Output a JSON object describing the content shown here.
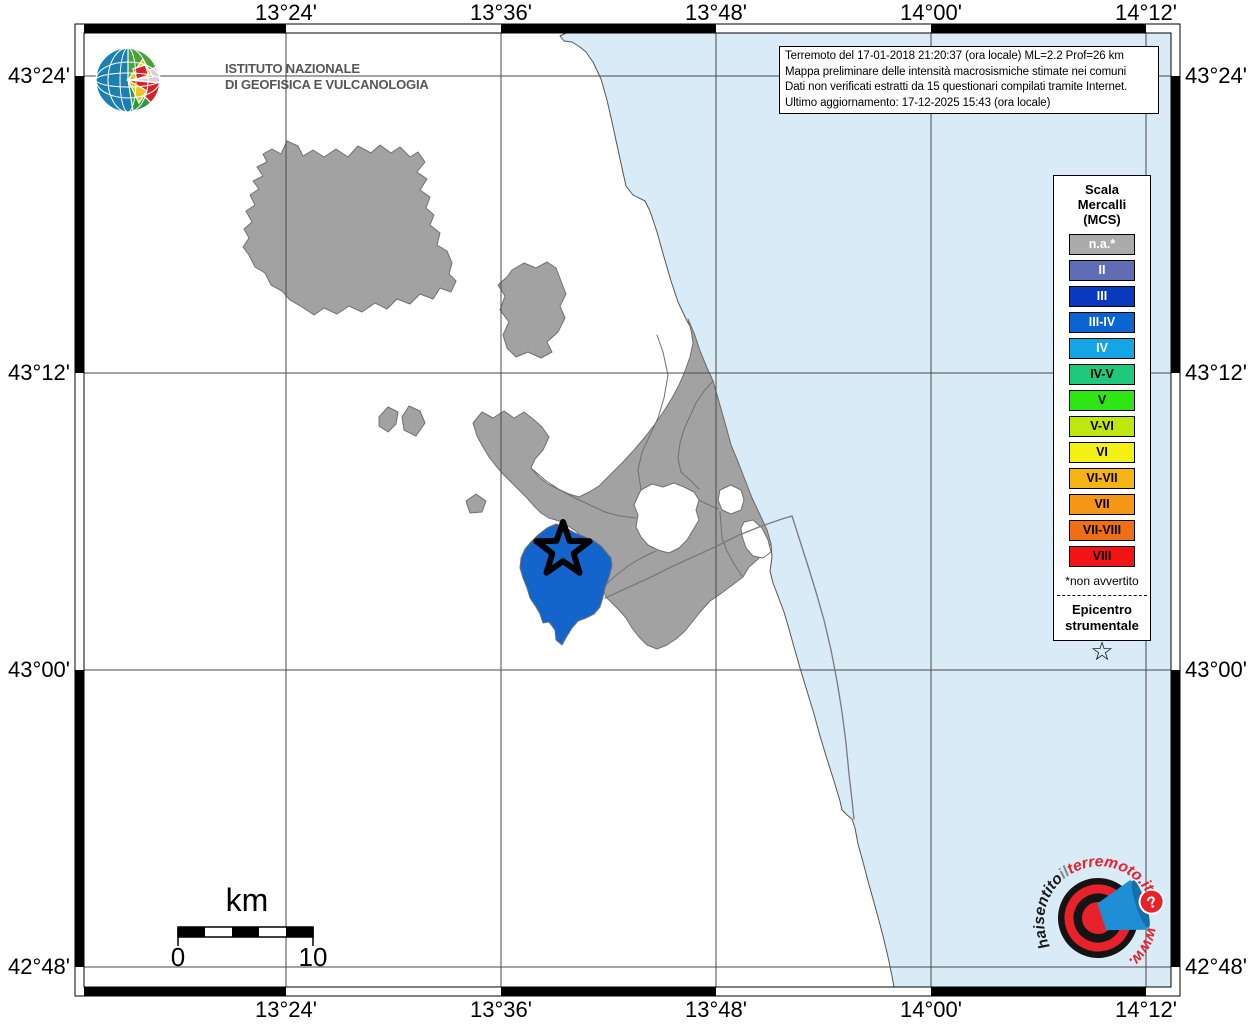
{
  "info_box": {
    "line1": "Terremoto del 17-01-2018 21:20:37 (ora locale) ML=2.2 Prof=26 km",
    "line2": "Mappa preliminare delle intensità macrosismiche stimate nei comuni",
    "line3": "Dati non verificati estratti da 15 questionari compilati tramite Internet.",
    "line4": "Ultimo aggiornamento: 17-12-2025 15:43 (ora locale)"
  },
  "frame": {
    "top_labels": [
      "13°24'",
      "13°36'",
      "13°48'",
      "14°00'",
      "14°12'"
    ],
    "bottom_labels": [
      "13°24'",
      "13°36'",
      "13°48'",
      "14°00'",
      "14°12'"
    ],
    "left_labels": [
      "43°24'",
      "43°12'",
      "43°00'",
      "42°48'"
    ],
    "right_labels": [
      "43°24'",
      "43°12'",
      "43°00'",
      "42°48'"
    ]
  },
  "ingv_logo": {
    "name_line1": "ISTITUTO NAZIONALE",
    "name_line2": "DI GEOFISICA E VULCANOLOGIA"
  },
  "legend": {
    "title_line1": "Scala",
    "title_line2": "Mercalli",
    "title_line3": "(MCS)",
    "items": [
      {
        "label": "n.a.*",
        "color": "#ABABAB",
        "text_color": "#FFFFFF"
      },
      {
        "label": "II",
        "color": "#5F6EB4",
        "text_color": "#FFFFFF"
      },
      {
        "label": "III",
        "color": "#0839BE",
        "text_color": "#FFFFFF"
      },
      {
        "label": "III-IV",
        "color": "#0A64D2",
        "text_color": "#FFFFFF"
      },
      {
        "label": "IV",
        "color": "#14A5E6",
        "text_color": "#FFFFFF"
      },
      {
        "label": "IV-V",
        "color": "#1EC87D",
        "text_color": "#000000"
      },
      {
        "label": "V",
        "color": "#2DE614",
        "text_color": "#000000"
      },
      {
        "label": "V-VI",
        "color": "#BEE60F",
        "text_color": "#000000"
      },
      {
        "label": "VI",
        "color": "#F5F014",
        "text_color": "#000000"
      },
      {
        "label": "VI-VII",
        "color": "#F5B414",
        "text_color": "#000000"
      },
      {
        "label": "VII",
        "color": "#F59614",
        "text_color": "#000000"
      },
      {
        "label": "VII-VIII",
        "color": "#F06E14",
        "text_color": "#000000"
      },
      {
        "label": "VIII",
        "color": "#F01414",
        "text_color": "#000000"
      }
    ],
    "footnote": "*non avvertito",
    "epicenter_line1": "Epicentro",
    "epicenter_line2": "strumentale",
    "epicenter_star": "☆"
  },
  "scale_bar": {
    "unit_label": "km",
    "start_label": "0",
    "end_label": "10"
  },
  "site_logo": {
    "arc_hai": "haisentito",
    "arc_il": "il",
    "arc_site": "terremoto.it",
    "arc_www": "www.",
    "badge": "?"
  },
  "map": {
    "inner": [
      84,
      33,
      1171,
      987
    ],
    "outer": [
      75,
      24,
      1180,
      996
    ],
    "grid_x": [
      286,
      501,
      716,
      931,
      1146
    ],
    "grid_y": [
      76,
      373,
      670,
      967
    ],
    "grid_color": "#4A4A4A",
    "sea_color": "#D9EBF7",
    "land_color": "#FFFFFF",
    "muni_fill": "#A2A2A2",
    "muni_stroke": "#707070",
    "felt_fill": "#1465CB",
    "layers": [
      {
        "name": "sea",
        "fill": "#D9EBF7",
        "stroke": "#555555",
        "sw": 1,
        "d": "M 566 33 L 560 36 L 564 41 L 572 42 L 580 47 L 586 52 L 593 62 L 601 79 L 607 100 L 612 122 L 617 145 L 622 168 L 626 186 L 633 195 L 645 201 L 650 211 L 657 232 L 664 257 L 671 281 L 678 302 L 687 321 L 694 333 L 700 351 L 707 368 L 713 381 L 719 402 L 725 423 L 731 445 L 738 462 L 745 480 L 752 498 L 760 515 L 767 530 L 771 544 L 772 557 L 770 571 L 773 583 L 778 596 L 784 612 L 789 629 L 794 647 L 800 668 L 807 691 L 814 714 L 820 736 L 827 759 L 834 781 L 840 801 L 842 810 L 847 815 L 852 819 L 855 828 L 858 844 L 863 862 L 868 881 L 873 899 L 878 917 L 883 936 L 888 957 L 892 976 L 894 987 L 1171 987 L 1171 33 Z"
      },
      {
        "name": "municipality-northwest",
        "fill": "#A2A2A2",
        "stroke": "#707070",
        "sw": 1,
        "d": "M 281 154 L 287 141 L 298 146 L 303 156 L 313 150 L 324 157 L 336 149 L 348 157 L 358 146 L 371 153 L 380 145 L 391 153 L 400 147 L 410 157 L 418 152 L 425 162 L 417 172 L 427 179 L 420 190 L 430 197 L 426 208 L 434 215 L 430 225 L 440 233 L 437 245 L 447 251 L 452 263 L 449 274 L 456 281 L 451 292 L 440 288 L 433 299 L 420 294 L 410 304 L 397 299 L 387 309 L 375 303 L 362 312 L 349 306 L 337 314 L 324 308 L 314 315 L 302 307 L 290 300 L 282 291 L 271 285 L 265 273 L 255 267 L 249 255 L 243 247 L 249 238 L 244 229 L 252 222 L 246 211 L 255 205 L 250 195 L 259 189 L 253 181 L 263 176 L 257 167 L 267 162 L 263 154 L 272 149 Z"
      },
      {
        "name": "municipality-north-center",
        "fill": "#A2A2A2",
        "stroke": "#707070",
        "sw": 1,
        "d": "M 512 270 L 524 263 L 536 268 L 547 262 L 556 268 L 561 281 L 566 294 L 560 306 L 565 318 L 558 332 L 547 342 L 552 352 L 541 358 L 528 352 L 516 357 L 507 348 L 503 335 L 509 322 L 500 310 L 505 296 L 498 285 L 507 277 Z"
      },
      {
        "name": "municipality-islet-a",
        "fill": "#A2A2A2",
        "stroke": "#707070",
        "sw": 1,
        "d": "M 379 417 L 388 407 L 398 412 L 396 424 L 388 432 L 379 426 Z"
      },
      {
        "name": "municipality-islet-b",
        "fill": "#A2A2A2",
        "stroke": "#707070",
        "sw": 1,
        "d": "M 402 417 L 409 406 L 420 411 L 425 423 L 416 436 L 404 430 Z"
      },
      {
        "name": "municipality-islet-c",
        "fill": "#A2A2A2",
        "stroke": "#707070",
        "sw": 1,
        "d": "M 466 501 L 476 494 L 486 501 L 482 512 L 470 513 Z"
      },
      {
        "name": "municipality-cluster",
        "fill": "#A2A2A2",
        "stroke": "#707070",
        "sw": 1,
        "d": "M 473 423 L 482 412 L 493 418 L 504 411 L 514 418 L 524 412 L 533 419 L 542 427 L 549 437 L 543 450 L 535 459 L 531 468 L 539 477 L 548 484 L 558 489 L 569 494 L 579 497 L 589 492 L 599 486 L 610 475 L 622 463 L 634 450 L 645 437 L 655 424 L 664 411 L 672 398 L 679 385 L 685 371 L 690 357 L 693 343 L 691 330 L 688 319 L 694 333 L 700 351 L 707 368 L 713 381 L 719 402 L 725 423 L 731 445 L 738 462 L 745 480 L 752 498 L 760 515 L 767 530 L 771 544 L 765 552 L 757 560 L 749 567 L 743 577 L 735 583 L 727 589 L 719 595 L 710 601 L 701 611 L 693 621 L 685 631 L 676 639 L 667 645 L 657 649 L 647 645 L 639 637 L 632 628 L 626 618 L 619 610 L 612 603 L 606 597 L 603 589 L 599 576 L 595 563 L 590 551 L 584 540 L 577 532 L 568 526 L 559 521 L 549 518 L 541 513 L 534 506 L 527 498 L 519 490 L 511 482 L 503 474 L 496 466 L 489 457 L 483 447 L 477 436 Z"
      },
      {
        "name": "white-enclave-inner",
        "fill": "#FFFFFF",
        "stroke": "#707070",
        "sw": 1,
        "d": "M 641 490 L 652 484 L 663 487 L 674 483 L 684 487 L 694 492 L 699 500 L 696 510 L 699 520 L 693 530 L 687 540 L 679 548 L 669 553 L 658 550 L 648 545 L 641 537 L 636 527 L 638 515 L 634 505 L 638 496 Z"
      },
      {
        "name": "white-enclave-coast-a",
        "fill": "#FFFFFF",
        "stroke": "#707070",
        "sw": 1,
        "d": "M 720 490 L 731 485 L 741 490 L 744 500 L 741 510 L 731 514 L 722 510 L 718 500 Z"
      },
      {
        "name": "white-enclave-coast-b",
        "fill": "#FFFFFF",
        "stroke": "#707070",
        "sw": 1,
        "d": "M 744 522 L 753 520 L 762 528 L 768 540 L 771 552 L 763 558 L 753 556 L 746 548 L 742 536 L 741 528 Z"
      },
      {
        "name": "municipal-border-1",
        "fill": "none",
        "stroke": "#707070",
        "sw": 1,
        "d": "M 641 490 L 638 470 L 642 452 L 650 435 L 658 418 L 664 398 L 668 375 L 663 352 L 657 335"
      },
      {
        "name": "municipal-border-2",
        "fill": "none",
        "stroke": "#707070",
        "sw": 1,
        "d": "M 713 381 L 704 391 L 696 403 L 690 416 L 684 429 L 680 443 L 678 458 L 681 472 L 690 480 L 699 489"
      },
      {
        "name": "municipal-border-3",
        "fill": "none",
        "stroke": "#707070",
        "sw": 1,
        "d": "M 531 468 L 545 480 L 560 490 L 575 498 L 590 505 L 605 512 L 620 516 L 636 518"
      },
      {
        "name": "municipal-border-4",
        "fill": "none",
        "stroke": "#707070",
        "sw": 1,
        "d": "M 602 588 L 614 577 L 628 566 L 643 557 L 656 551"
      },
      {
        "name": "municipal-border-5",
        "fill": "none",
        "stroke": "#707070",
        "sw": 1,
        "d": "M 699 500 L 709 505 L 718 509"
      },
      {
        "name": "municipal-border-6",
        "fill": "none",
        "stroke": "#707070",
        "sw": 1,
        "d": "M 742 576 L 734 564 L 727 551 L 722 538 L 721 524 L 720 512"
      },
      {
        "name": "felt-municipality-iii-iv",
        "fill": "#1465CB",
        "stroke": "#707070",
        "sw": 1,
        "d": "M 547 528 L 556 524 L 566 528 L 575 533 L 585 537 L 594 541 L 601 546 L 606 552 L 611 558 L 612 566 L 609 577 L 605 588 L 603 597 L 600 607 L 594 614 L 586 618 L 578 621 L 572 628 L 567 636 L 562 645 L 556 640 L 555 630 L 549 622 L 543 623 L 540 614 L 536 607 L 530 598 L 527 588 L 523 578 L 520 568 L 521 558 L 525 549 L 531 542 L 538 535 Z"
      }
    ],
    "overlays": [
      {
        "name": "road-1",
        "fill": "none",
        "stroke": "#7A7A7A",
        "sw": 1.3,
        "d": "M 605 598 L 627 588 L 649 578 L 671 567 L 693 557 L 715 547 L 737 536 L 759 527 L 782 519 L 792 516"
      },
      {
        "name": "road-2",
        "fill": "none",
        "stroke": "#7A7A7A",
        "sw": 1.3,
        "d": "M 792 516 L 800 541 L 808 566 L 816 592 L 824 620 L 831 650 L 837 681 L 842 712 L 846 743 L 849 774 L 852 800 L 854 819"
      },
      {
        "name": "epicenter-star",
        "fill": "none",
        "stroke": "#000000",
        "sw": 6,
        "d": "M 563 522 L 569.6 540.9 L 589.6 541.3 L 573.7 553.5 L 579.5 572.7 L 563 561.2 L 546.5 572.7 L 552.3 553.5 L 536.4 541.3 L 556.4 540.9 Z"
      }
    ]
  }
}
